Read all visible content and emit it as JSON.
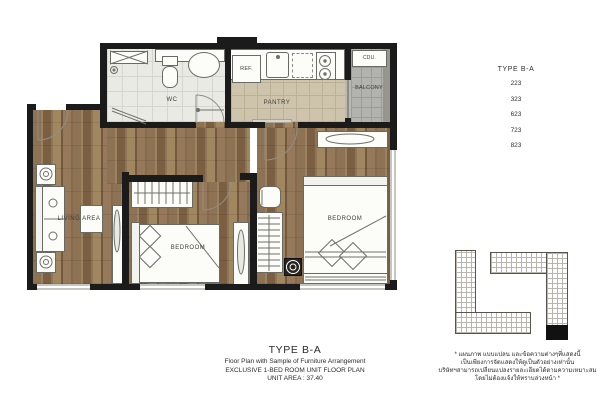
{
  "plan": {
    "labels": {
      "wc": "WC",
      "pantry": "PANTRY",
      "balcony": "BALCONY",
      "cdu": "CDU.",
      "ref": "REF.",
      "living": "LIVING AREA",
      "bedroom_mid": "BEDROOM",
      "bedroom_right": "BEDROOM"
    }
  },
  "unit_list": {
    "heading": "TYPE B-A",
    "units": [
      "223",
      "323",
      "623",
      "723",
      "823"
    ]
  },
  "caption": {
    "title": "TYPE B-A",
    "subtitle": "Floor Plan with Sample of Furniture Arrangement",
    "line2": "EXCLUSIVE 1-BED ROOM UNIT FLOOR PLAN",
    "line3": "UNIT AREA : 37.40"
  },
  "disclaimer": {
    "lines": [
      "* แผนภาพ แบบแปลน และข้อความต่างๆที่แสดงนี้",
      "เป็นเพียงการจัดแสดงให้ดูเป็นตัวอย่างเท่านั้น",
      "บริษัทฯสามารถเปลี่ยนแปลงรายละเอียดได้ตามความเหมาะสม",
      "โดยไม่ต้องแจ้งให้ทราบล่วงหน้า *"
    ]
  },
  "colors": {
    "wall": "#1b1b1b",
    "wood": "#8a6f51",
    "wc_tile": "#eaeae5",
    "pantry_tile": "#cec3ab",
    "balcony_tile": "#b2b2ae",
    "unit_marker": "#111111"
  }
}
